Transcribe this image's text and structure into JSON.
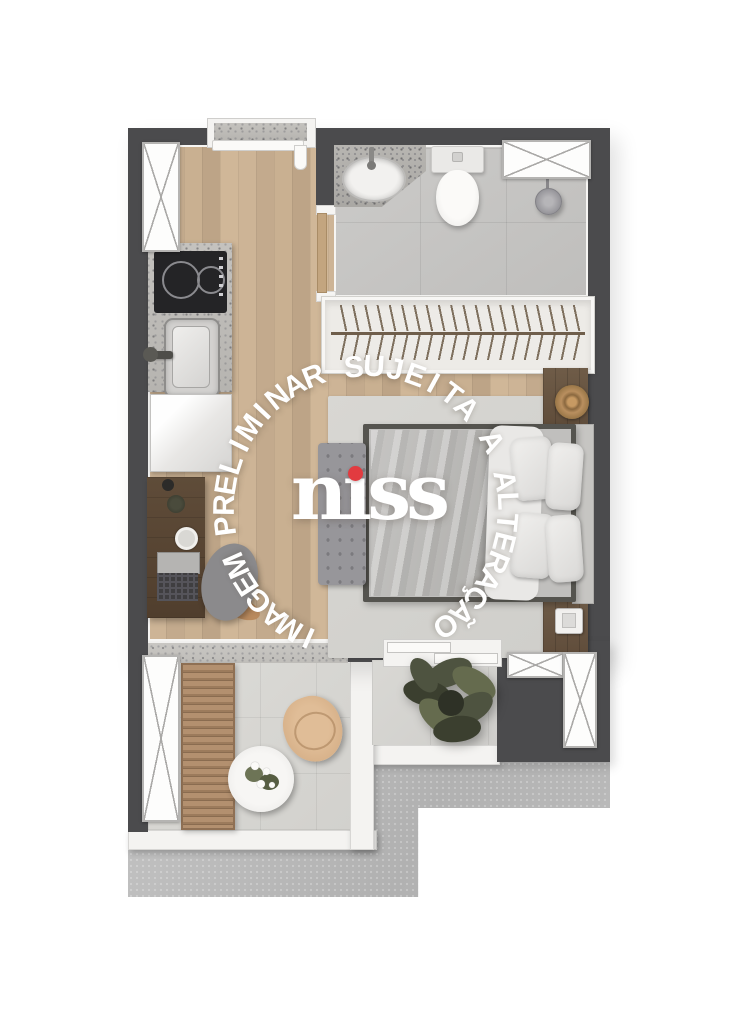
{
  "watermark": {
    "text": "IMAGEM PRELIMINAR SUJEITA A ALTERAÇÃO",
    "color": "#ffffff",
    "center_x": 366,
    "center_y": 508,
    "radius": 141,
    "start_angle_deg": 204,
    "end_angle_deg": 506,
    "font_size_px": 30
  },
  "logo": {
    "brand": "niss",
    "display_text": "nıss",
    "text_color": "#ffffff",
    "dot_color": "#e23b40"
  },
  "palette": {
    "wall": "#4b4b4d",
    "wood_floor": "#c7ae91",
    "bath_tile": "#c6c5c3",
    "balcony_tile": "#d8d7d3",
    "concrete": "#b9b9b9",
    "rug": "#d4d3cf",
    "deck_wood": "#a9886a",
    "accent_red": "#e23b40"
  },
  "fixtures": [
    "entry-door",
    "kitchen-counter",
    "cooktop",
    "kitchen-sink",
    "refrigerator",
    "desk",
    "desk-chair",
    "laptop",
    "wardrobe",
    "bathroom-sink",
    "toilet",
    "shower",
    "double-bed",
    "pillows",
    "bench",
    "nightstands",
    "decor-tray",
    "rug",
    "balcony-lounger",
    "balcony-table",
    "balcony-chair",
    "potted-plant",
    "windows",
    "sliding-door"
  ]
}
